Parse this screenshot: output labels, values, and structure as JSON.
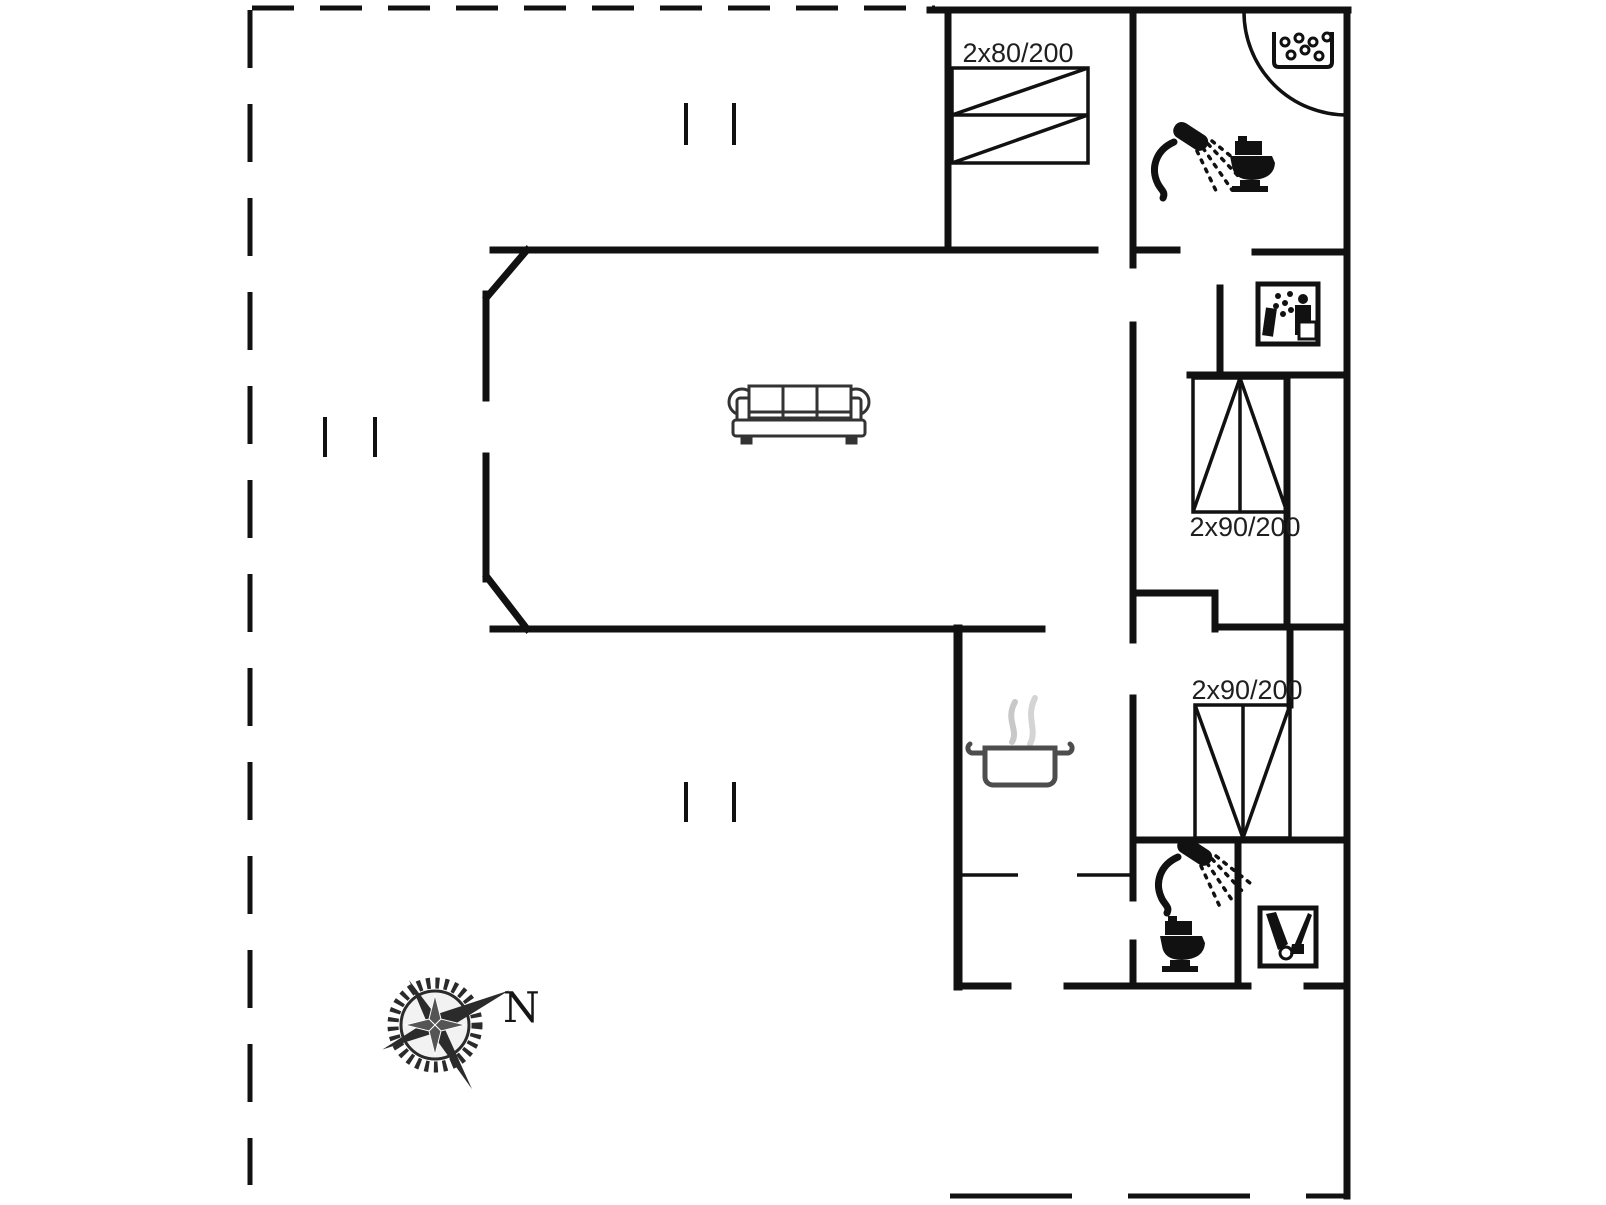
{
  "plan": {
    "type": "floor-plan",
    "labels": {
      "bed_top": "2x80/200",
      "bed_upper_right": "2x90/200",
      "bed_lower_right": "2x90/200",
      "compass_north": "N"
    },
    "colors": {
      "wall": "#111111",
      "label_text": "#1f1f1f",
      "pot_stroke": "#4d4d4d",
      "steam": "#c8c8c8",
      "compass": "#2b2b2b",
      "background": "#ffffff"
    },
    "icons": [
      "floor-drain-icon",
      "shower-icon",
      "toilet-icon",
      "shower-cabin-icon",
      "vacuum-cleaner-icon",
      "double-bed-icon",
      "sofa-icon",
      "cooking-pot-icon",
      "door-swing-arc",
      "compass-rose-icon"
    ]
  }
}
